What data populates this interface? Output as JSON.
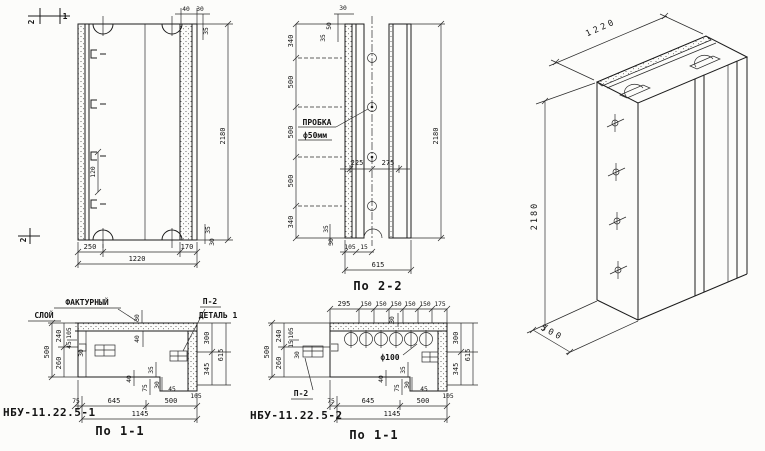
{
  "palette": {
    "paper": "#fcfcfa",
    "ink": "#1c1c1c"
  },
  "views": {
    "front": {
      "cut_marks": {
        "top_2": "2",
        "top_1": "1",
        "bottom_2": "2"
      },
      "dims": {
        "top_40": "40",
        "top_30": "30",
        "top_35": "35",
        "hook_spacing": "120",
        "height": "2180",
        "bottom_250": "250",
        "bottom_170": "170",
        "width": "1220",
        "edge_35": "35",
        "edge_30": "30"
      }
    },
    "side": {
      "caption": "По 2-2",
      "plug_note": {
        "line1": "ПРОБКА",
        "line2": "ф50мм"
      },
      "dims": {
        "top_30": "30",
        "top_50": "50",
        "top_35": "35",
        "v340_top": "340",
        "v500_1": "500",
        "v500_2": "500",
        "v500_3": "500",
        "v340_bottom": "340",
        "h225": "225",
        "h275": "275",
        "height": "2180",
        "b105": "105",
        "b15": "15",
        "edge_35": "35",
        "edge_30": "30",
        "width": "615"
      }
    },
    "isometric": {
      "dims": {
        "width": "1220",
        "height": "2180",
        "depth": "500"
      }
    },
    "section_a": {
      "caption": "По 1-1",
      "mark": "НБУ-11.22.5-1",
      "facture_note": {
        "line1": "ФАКТУРНЫЙ",
        "line2": "СЛОЙ"
      },
      "detail_note": {
        "line1": "П-2",
        "line2": "ДЕТАЛЬ 1"
      },
      "dims": {
        "left_500": "500",
        "left_240": "240",
        "left_260": "260",
        "left_105": "105",
        "left_45": "45",
        "wall_30": "30",
        "top_30": "30",
        "inner_40": "40",
        "right_300": "300",
        "right_345": "345",
        "right_615": "615",
        "foot_105": "105",
        "step_40": "40",
        "step_75": "75",
        "step_35": "35",
        "step_30": "30",
        "step_45": "45",
        "bot_75": "75",
        "bot_645": "645",
        "bot_500": "500",
        "bot_1145": "1145"
      }
    },
    "section_b": {
      "caption": "По 1-1",
      "mark": "НБУ-11.22.5-2",
      "hole_note": "ф100",
      "detail_note": "П-2",
      "dims": {
        "top_295": "295",
        "top_150s": [
          "150",
          "150",
          "150",
          "150",
          "150"
        ],
        "top_175": "175",
        "top_30": "30",
        "left_500": "500",
        "left_240": "240",
        "left_260": "260",
        "left_105": "105",
        "left_15": "15",
        "wall_30": "30",
        "right_300": "300",
        "right_345": "345",
        "right_615": "615",
        "foot_105": "105",
        "step_40": "40",
        "step_75": "75",
        "step_35": "35",
        "step_30": "30",
        "step_45": "45",
        "bot_75": "75",
        "bot_645": "645",
        "bot_500": "500",
        "bot_1145": "1145"
      }
    }
  }
}
